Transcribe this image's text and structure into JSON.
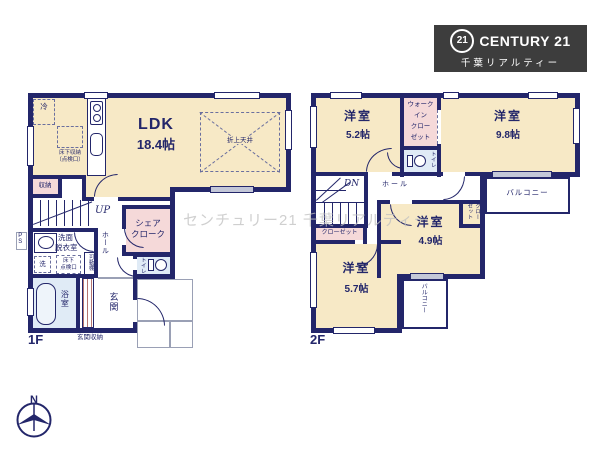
{
  "logo": {
    "seal": "21",
    "brand": "CENTURY 21",
    "subtitle": "千葉リアルティー"
  },
  "watermark": "センチュリー21 千葉リアルティー",
  "compass": {
    "north": "N"
  },
  "floor1": {
    "label": "1F",
    "ldk": {
      "name": "LDK",
      "size": "18.4帖"
    },
    "fridge": "冷",
    "underfloor_storage": [
      "床下収納",
      "（点検口）"
    ],
    "raised_ceiling": "折上天井",
    "closet": "収納",
    "stairs_up": "UP",
    "share_closet": [
      "シェア",
      "クローク"
    ],
    "hall": "ホール",
    "pipe_space": "PS",
    "washroom": [
      "洗面",
      "脱衣室"
    ],
    "washer": "洗",
    "underfloor_hatch": [
      "床下",
      "点検口"
    ],
    "movable_shelf": "可動棚",
    "toilet": "トイレ",
    "bath": "浴室",
    "entrance": "玄関",
    "entrance_storage": "玄関収納"
  },
  "floor2": {
    "label": "2F",
    "rooms": [
      {
        "name": "洋室",
        "size": "5.2帖"
      },
      {
        "name": "洋室",
        "size": "9.8帖"
      },
      {
        "name": "洋室",
        "size": "4.9帖"
      },
      {
        "name": "洋室",
        "size": "5.7帖"
      }
    ],
    "wic_lines": [
      "ウォーク",
      "イン",
      "クロー",
      "ゼット"
    ],
    "toilet": "トイレ",
    "stairs_down": "DN",
    "hall": "ホール",
    "balcony_right": "バルコニー",
    "balcony_bottom": "バルコニー",
    "closet_small": "クローゼット",
    "closet_left": "クローゼット"
  },
  "colors": {
    "wall": "#23266a",
    "room_cream": "#f7e9c6",
    "closet_pink": "#f5d9d9",
    "wet_area_blue": "#e0ebf6",
    "logo_bg": "#3d3d3d",
    "watermark_gray": "#c0c0c0"
  }
}
